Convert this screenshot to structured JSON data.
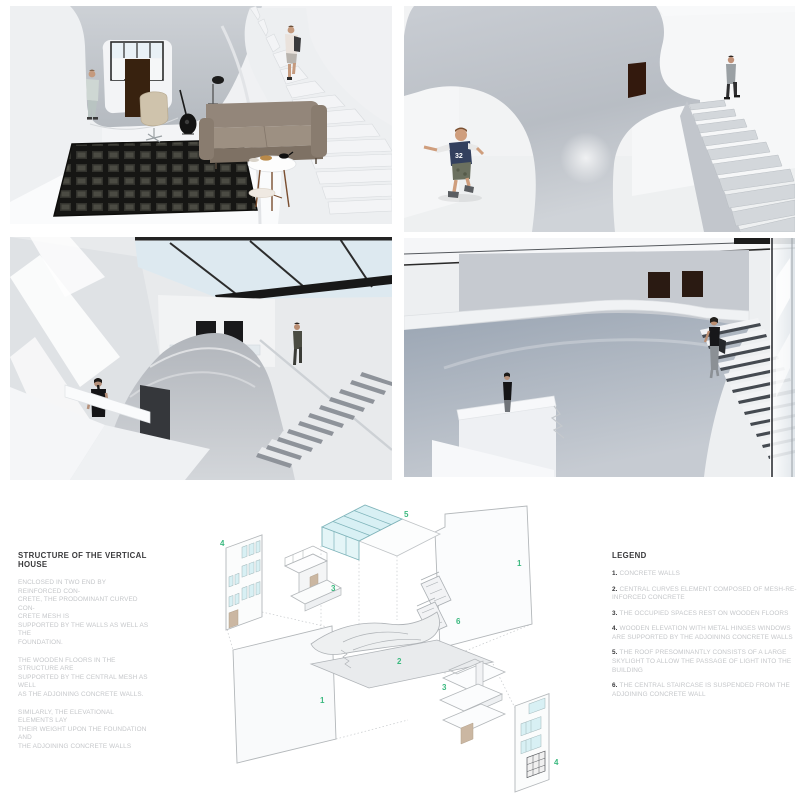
{
  "structure_note": {
    "title": "STRUCTURE OF THE VERTICAL HOUSE",
    "paragraphs": [
      "ENCLOSED IN TWO END BY REINFORCED CON-\nCRETE, THE PRODOMINANT CURVED CON-\nCRETE MESH IS\nSUPPORTED BY THE WALLS AS WELL AS THE\nFOUNDATION.",
      "THE WOODEN FLOORS IN THE STRUCTURE ARE\nSUPPORTED BY THE CENTRAL MESH AS WELL\nAS THE ADJOINING CONCRETE WALLS.",
      "SIMILARLY, THE ELEVATIONAL ELEMENTS LAY\nTHEIR WEIGHT UPON THE FOUNDATION AND\nTHE ADJOINING CONCRETE WALLS"
    ]
  },
  "legend": {
    "title": "LEGEND",
    "items": [
      {
        "num": "1.",
        "text": "CONCRETE WALLS"
      },
      {
        "num": "2.",
        "text": "CENTRAL CURVES ELEMENT COMPOSED OF MESH-RE-\nINFORCED CONCRETE"
      },
      {
        "num": "3.",
        "text": "THE OCCUPIED SPACES REST ON WOODEN FLOORS"
      },
      {
        "num": "4.",
        "text": "WOODEN ELEVATION WITH METAL HINGES WINDOWS\nARE SUPPORTED BY THE ADJOINING CONCRETE WALLS"
      },
      {
        "num": "5.",
        "text": "THE ROOF PRESOMINANTLY CONSISTS OF A LARGE\nSKYLIGHT TO ALLOW THE PASSAGE OF LIGHT INTO THE\nBUILDING"
      },
      {
        "num": "6.",
        "text": "THE CENTRAL STAIRCASE IS SUSPENDED FROM THE\nADJOINING CONCRETE WALL"
      }
    ]
  },
  "diagram": {
    "labels": [
      {
        "text": "4"
      },
      {
        "text": "3"
      },
      {
        "text": "5"
      },
      {
        "text": "1"
      },
      {
        "text": "6"
      },
      {
        "text": "2"
      },
      {
        "text": "1"
      },
      {
        "text": "3"
      },
      {
        "text": "4"
      }
    ],
    "accent_color": "#3bb97f",
    "glass_color": "#d8f0f4"
  },
  "renders": {
    "child_jersey_number": "32"
  },
  "colors": {
    "accent_green": "#3bb97f",
    "glass_cyan": "#d8f0f4",
    "concrete_gray": "#c3c7cd",
    "sofa_taupe": "#93867a",
    "door_brown": "#38220f",
    "sky_blue": "#dde9f0"
  }
}
